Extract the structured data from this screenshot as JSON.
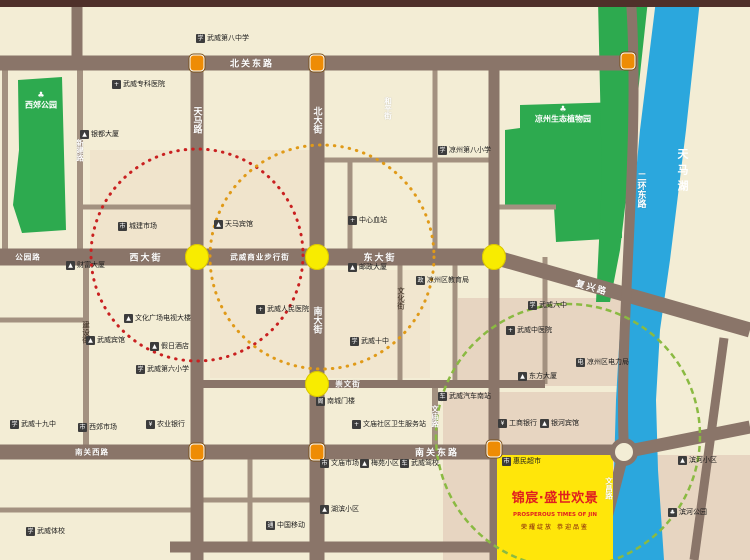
{
  "map": {
    "project": {
      "name": "锦宸·盛世欢景",
      "subtitle_en": "PROSPEROUS TIMES OF JIN",
      "tagline": "荣耀绽放 恭迎品鉴"
    },
    "water": {
      "lake_label": "天马湖"
    },
    "parks": [
      {
        "name": "西郊公园",
        "x": 41,
        "y": 100
      },
      {
        "name": "凉州生态植物园",
        "x": 563,
        "y": 114
      }
    ],
    "road_labels": [
      {
        "text": "北关东路",
        "x": 252,
        "y": 63,
        "dir": "h"
      },
      {
        "text": "公园路",
        "x": 28,
        "y": 257,
        "dir": "h",
        "small": true
      },
      {
        "text": "西大街",
        "x": 146,
        "y": 257,
        "dir": "h"
      },
      {
        "text": "武威商业步行街",
        "x": 260,
        "y": 257,
        "dir": "h",
        "small": true
      },
      {
        "text": "东大街",
        "x": 380,
        "y": 257,
        "dir": "h"
      },
      {
        "text": "复兴路",
        "x": 592,
        "y": 287,
        "dir": "h",
        "angle": 16
      },
      {
        "text": "南关西路",
        "x": 92,
        "y": 452,
        "dir": "h",
        "small": true
      },
      {
        "text": "南关东路",
        "x": 437,
        "y": 452,
        "dir": "h"
      },
      {
        "text": "崇文街",
        "x": 348,
        "y": 384,
        "dir": "h",
        "small": true
      },
      {
        "text": "天马路",
        "x": 197,
        "y": 120,
        "dir": "v"
      },
      {
        "text": "北大街",
        "x": 317,
        "y": 120,
        "dir": "v"
      },
      {
        "text": "南大街",
        "x": 317,
        "y": 320,
        "dir": "v"
      },
      {
        "text": "和平街",
        "x": 388,
        "y": 108,
        "dir": "v",
        "small": true
      },
      {
        "text": "文化街",
        "x": 401,
        "y": 298,
        "dir": "v",
        "dark": true,
        "small": true
      },
      {
        "text": "新建路",
        "x": 80,
        "y": 150,
        "dir": "v",
        "small": true
      },
      {
        "text": "建设街",
        "x": 86,
        "y": 332,
        "dir": "v",
        "dark": true,
        "small": true
      },
      {
        "text": "二环东路",
        "x": 641,
        "y": 190,
        "dir": "v"
      },
      {
        "text": "文庙路",
        "x": 435,
        "y": 416,
        "dir": "v",
        "small": true
      },
      {
        "text": "文昌路",
        "x": 609,
        "y": 488,
        "dir": "v",
        "small": true
      }
    ],
    "landmarks": [
      {
        "name": "武威第八中学",
        "icon": "学",
        "x": 196,
        "y": 38
      },
      {
        "name": "凉州第八小学",
        "icon": "学",
        "x": 438,
        "y": 150
      },
      {
        "name": "银都大厦",
        "icon": "▲",
        "x": 80,
        "y": 134
      },
      {
        "name": "武威专科医院",
        "icon": "+",
        "x": 112,
        "y": 84
      },
      {
        "name": "城建市场",
        "icon": "市",
        "x": 118,
        "y": 226
      },
      {
        "name": "天马宾馆",
        "icon": "▲",
        "x": 214,
        "y": 224
      },
      {
        "name": "中心血站",
        "icon": "+",
        "x": 348,
        "y": 220
      },
      {
        "name": "邮政大厦",
        "icon": "▲",
        "x": 348,
        "y": 267
      },
      {
        "name": "凉州区教育局",
        "icon": "政",
        "x": 416,
        "y": 280
      },
      {
        "name": "财富大厦",
        "icon": "▲",
        "x": 66,
        "y": 265
      },
      {
        "name": "武威宾馆",
        "icon": "▲",
        "x": 86,
        "y": 340
      },
      {
        "name": "文化广场电视大楼",
        "icon": "▲",
        "x": 124,
        "y": 318
      },
      {
        "name": "假日酒店",
        "icon": "▲",
        "x": 150,
        "y": 346
      },
      {
        "name": "武威第六小学",
        "icon": "学",
        "x": 136,
        "y": 369
      },
      {
        "name": "武威人民医院",
        "icon": "+",
        "x": 256,
        "y": 309
      },
      {
        "name": "武威十中",
        "icon": "学",
        "x": 350,
        "y": 341
      },
      {
        "name": "南城门楼",
        "icon": "阁",
        "x": 316,
        "y": 401
      },
      {
        "name": "文庙社区卫生服务站",
        "icon": "+",
        "x": 352,
        "y": 424
      },
      {
        "name": "文庙市场",
        "icon": "市",
        "x": 320,
        "y": 463
      },
      {
        "name": "梅苑小区",
        "icon": "▲",
        "x": 360,
        "y": 463
      },
      {
        "name": "武威驾校",
        "icon": "车",
        "x": 400,
        "y": 463
      },
      {
        "name": "湖滨小区",
        "icon": "▲",
        "x": 320,
        "y": 509
      },
      {
        "name": "中国移动",
        "icon": "通",
        "x": 266,
        "y": 525
      },
      {
        "name": "武威体校",
        "icon": "学",
        "x": 26,
        "y": 531
      },
      {
        "name": "武威十九中",
        "icon": "学",
        "x": 10,
        "y": 424
      },
      {
        "name": "西郊市场",
        "icon": "市",
        "x": 78,
        "y": 427
      },
      {
        "name": "农业银行",
        "icon": "¥",
        "x": 146,
        "y": 424
      },
      {
        "name": "武威汽车南站",
        "icon": "车",
        "x": 438,
        "y": 396
      },
      {
        "name": "武威六中",
        "icon": "学",
        "x": 528,
        "y": 305
      },
      {
        "name": "武威中医院",
        "icon": "+",
        "x": 506,
        "y": 330
      },
      {
        "name": "凉州区电力局",
        "icon": "电",
        "x": 576,
        "y": 362
      },
      {
        "name": "东方大厦",
        "icon": "▲",
        "x": 518,
        "y": 376
      },
      {
        "name": "工商银行",
        "icon": "¥",
        "x": 498,
        "y": 423
      },
      {
        "name": "银河宾馆",
        "icon": "▲",
        "x": 540,
        "y": 423
      },
      {
        "name": "滨河小区",
        "icon": "▲",
        "x": 678,
        "y": 460
      },
      {
        "name": "滨河公园",
        "icon": "♣",
        "x": 668,
        "y": 512
      },
      {
        "name": "惠民超市",
        "icon": "市",
        "x": 502,
        "y": 461
      }
    ],
    "markers": [
      {
        "type": "signal",
        "x": 197,
        "y": 63
      },
      {
        "type": "signal",
        "x": 317,
        "y": 63
      },
      {
        "type": "signal",
        "x": 628,
        "y": 61
      },
      {
        "type": "junction",
        "x": 197,
        "y": 257
      },
      {
        "type": "junction",
        "x": 317,
        "y": 257
      },
      {
        "type": "junction",
        "x": 494,
        "y": 257
      },
      {
        "type": "junction",
        "x": 317,
        "y": 384
      },
      {
        "type": "signal",
        "x": 197,
        "y": 452
      },
      {
        "type": "signal",
        "x": 317,
        "y": 452
      },
      {
        "type": "signal",
        "x": 494,
        "y": 449
      },
      {
        "type": "roundabout",
        "x": 624,
        "y": 452
      }
    ],
    "colors": {
      "road": "#8a7569",
      "river": "#2ba7dd",
      "park_green": "#2daa4f",
      "highlight_yellow": "#ffe60a",
      "circle_red": "#c92020",
      "circle_orange": "#e09a18",
      "circle_green": "#8aba42"
    }
  }
}
